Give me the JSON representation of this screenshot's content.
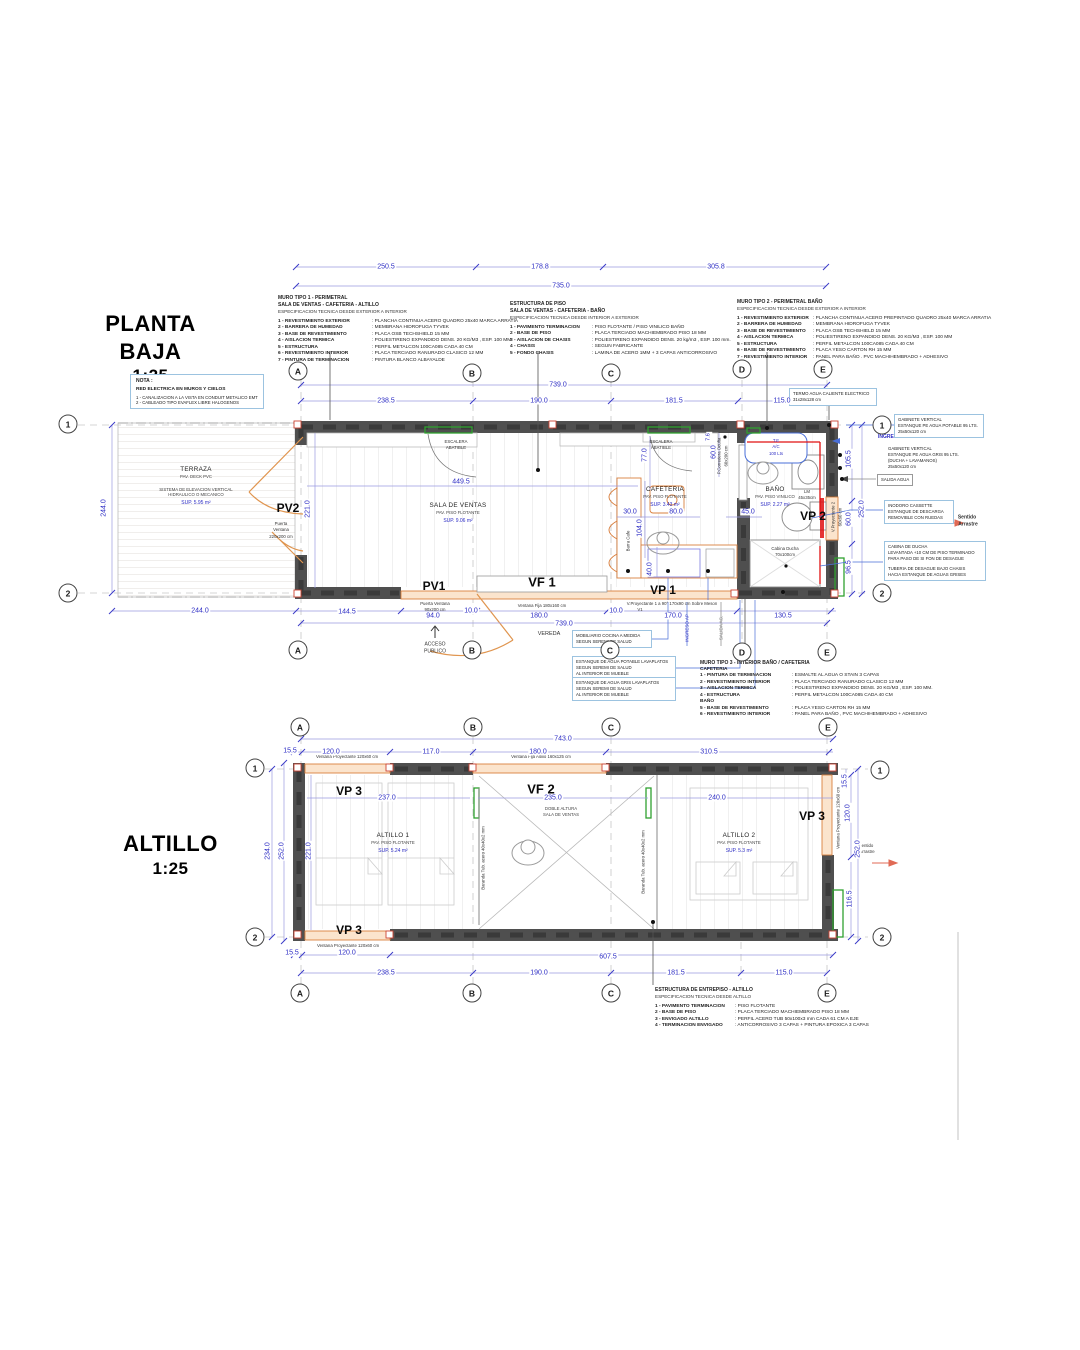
{
  "titles": {
    "pb": "PLANTA BAJA",
    "pb_scale": "1:25",
    "alt": "ALTILLO",
    "alt_scale": "1:25"
  },
  "grid": {
    "a": "A",
    "b": "B",
    "c": "C",
    "d": "D",
    "e": "E",
    "r1": "1",
    "r2": "2"
  },
  "nota": {
    "t": "NOTA :",
    "s": "RED ELECTRICA EN MUROS Y CIELOS",
    "l1": "1 - CANALIZACION A LA VISTA EN CONDUIT METALICO EMT",
    "l2": "2 - CABLEADO TIPO EVAFLEX LIBRE HALOGENOS"
  },
  "specs": {
    "muro1": {
      "t1": "MURO TIPO 1 - PERIMETRAL",
      "t2": "SALA DE VENTAS - CAFETERIA - ALTILLO",
      "t3": "ESPECIFICACION TECNICA DESDE EXTERIOR A INTERIOR",
      "items": [
        {
          "k": "1 - REVESTIMIENTO EXTERIOR",
          "v": ": PLANCHA CONTINUA ACERO QUADRO 25x40 MARCA ARRATIA"
        },
        {
          "k": "2 - BARRERA DE HUMEDAD",
          "v": ": MEMBRANA HIDROFUGA TYVEK"
        },
        {
          "k": "3 - BASE DE REVESTIMIENTO",
          "v": ": PLACA OSB TECHSHIELD 15 MM"
        },
        {
          "k": "4 - AISLACION TERMICA",
          "v": ": POLIESTIRENO EXPANDIDO DENS. 20 KG/M3 , ESP. 100 MM"
        },
        {
          "k": "5 - ESTRUCTURA",
          "v": ": PERFIL METALCON 100CA085 CADA 40 CM"
        },
        {
          "k": "6 - REVESTIMIENTO INTERIOR",
          "v": ": PLACA TERCIADO RANURADO CLASICO 12 MM"
        },
        {
          "k": "7 - PINTURA DE TERMINACION",
          "v": ": PINTURA BLANCO ALBAYALDE"
        }
      ]
    },
    "piso": {
      "t1": "ESTRUCTURA DE PISO",
      "t2": "SALA DE VENTAS - CAFETERIA - BAÑO",
      "t3": "ESPECIFICACION TECNICA DESDE INTERIOR A EXTERIOR",
      "items": [
        {
          "k": "1 - PAVIMENTO TERMINACION",
          "v": ": PISO FLOTANTE / PISO VINILICO BAÑO"
        },
        {
          "k": "2 - BASE DE PISO",
          "v": ": PLACA TERCIADO MACHIEMBRADO PISO 18 MM"
        },
        {
          "k": "3 - AISLACION DE CHASIS",
          "v": ": POLIESTIRENO EXPANDIDO DENS. 20 kg/m3 , ESP. 100 mm."
        },
        {
          "k": "4 - CHASIS",
          "v": ": SEGUN FABRICANTE"
        },
        {
          "k": "5 - FONDO CHASIS",
          "v": ": LAMINA DE ACERO 1MM + 3 CAPAS ANTICORROSIVO"
        }
      ]
    },
    "muro2": {
      "t1": "MURO TIPO 2 - PERIMETRAL BAÑO",
      "t3": "ESPECIFICACION TECNICA DESDE EXTERIOR A INTERIOR",
      "items": [
        {
          "k": "1 - REVESTIMIENTO EXTERIOR",
          "v": ": PLANCHA CONTINUA ACERO PREPINTADO QUADRO 25x40 MARCA ARRATIA"
        },
        {
          "k": "2 - BARRERA DE HUMEDAD",
          "v": ": MEMBRANA HIDROFUGA TYVEK"
        },
        {
          "k": "3 - BASE DE REVESTIMIENTO",
          "v": ": PLACA OSB TECHSHIELD 15 MM"
        },
        {
          "k": "4 - AISLACION TERMICA",
          "v": ": POLIESTIRENO EXPANDIDO DENS. 20 KG/M3 , ESP. 100 MM"
        },
        {
          "k": "5 - ESTRUCTURA",
          "v": ": PERFIL METALCON 100CA085 CADA 40 CM"
        },
        {
          "k": "6 - BASE DE REVESTIMIENTO",
          "v": ": PLACA YESO CARTON RH 15 MM"
        },
        {
          "k": "7 - REVESTIMIENTO INTERIOR",
          "v": ": PANEL PARA BAÑO . PVC MACHIHEMBRADO + ADHESIVO"
        }
      ]
    },
    "muro3": {
      "t1": "MURO TIPO 3 - INTERIOR BAÑO / CAFETERIA",
      "s1": "CAFETERIA",
      "items1": [
        {
          "k": "1 - PINTURA DE TERMINACION",
          "v": ": ESMALTE AL AGUA O STAIN 3 CAPAS"
        },
        {
          "k": "2 - REVESTIMIENTO INTERIOR",
          "v": ": PLACA TERCIADO RANURADO CLASICO 12 MM"
        },
        {
          "k": "3 - AISLACION TERMICA",
          "v": ": POLIESTIRENO EXPANDIDO DENS. 20 KG/M3 , ESP. 100 MM."
        },
        {
          "k": "4 - ESTRUCTURA",
          "v": ": PERFIL METALCON 100CA085 CADA 40 CM"
        }
      ],
      "s2": "BAÑO",
      "items2": [
        {
          "k": "5 - BASE DE REVESTIMIENTO",
          "v": ": PLACA YESO CARTON RH 15 MM"
        },
        {
          "k": "6 - REVESTIMIENTO INTERIOR",
          "v": ": PANEL PARA BAÑO , PVC MACHIHEMBRADO + ADHESIVO"
        }
      ]
    },
    "entrepiso": {
      "t1": "ESTRUCTURA DE ENTREPISO - ALTILLO",
      "t3": "ESPECIFICACION TECNICA DESDE ALTILLO",
      "items": [
        {
          "k": "1 - PAVIMENTO TERMINACION",
          "v": ": PISO FLOTANTE"
        },
        {
          "k": "2 - BASE DE PISO",
          "v": ": PLACA TERCIADO MACHIEMBRADO PISO 18 MM"
        },
        {
          "k": "3 - ENVIGADO ALTILLO",
          "v": ": PERFIL ACERO TUB 50x100x3 mm CADA 61 CM A EJE"
        },
        {
          "k": "4 - TERMINACION ENVIGADO",
          "v": ": ANTICORROSIVO 3 CAPAS + PINTURA EPOXICA 3 CAPAS"
        }
      ]
    }
  },
  "rooms": {
    "terraza": {
      "name": "TERRAZA",
      "pav": "PAV. DECK PVC",
      "e1": "SISTEMA DE ELEVACION VERTICAL",
      "e2": "HIDRAULICO O MECANICO",
      "sup": "SUP. 5.95 m²"
    },
    "sala": {
      "name": "SALA DE VENTAS",
      "pav": "PAV. PISO FLOTANTE",
      "sup": "SUP. 9.06 m²"
    },
    "cafeteria": {
      "name": "CAFETERIA",
      "pav": "PAV. PISO FLOTANTE",
      "sup": "SUP. 3.43 m²"
    },
    "bano": {
      "name": "BAÑO",
      "pav": "PAV. PISO VINILICO",
      "sup": "SUP. 2.27 m²"
    },
    "altillo1": {
      "name": "ALTILLO 1",
      "pav": "PAV. PISO FLOTANTE",
      "sup": "SUP. 5.24 m²"
    },
    "altillo2": {
      "name": "ALTILLO 2",
      "pav": "PAV. PISO FLOTANTE",
      "sup": "SUP. 5.3 m²"
    },
    "doble": {
      "l1": "DOBLE ALTURA",
      "l2": "SALA DE VENTAS"
    }
  },
  "windows": {
    "pv2": {
      "tag": "PV2",
      "l1": "Puerta",
      "l2": "Ventana",
      "l3": "220x200 cm"
    },
    "pv1": {
      "tag": "PV1",
      "l1": "Puerta Ventana",
      "l2": "90x200 cm"
    },
    "vf1": {
      "tag": "VF 1",
      "l1": "Ventana Fija 180x160 cm"
    },
    "vp1": {
      "tag": "VP 1",
      "l1": "V.Proyectante 1 a 90° 170x90 cm Sobre Meson",
      "l2": "V1"
    },
    "vp2": {
      "tag": "VP 2",
      "l1": "V.Proyectante 2",
      "l2": "60x60 cm"
    },
    "vf2": {
      "tag": "VF 2",
      "l1": "Ventana Fija Altillo 160x125 cm"
    },
    "vp3": {
      "tag": "VP 3",
      "l1": "Ventana Proyectante 120x60 cm"
    }
  },
  "labels": {
    "escalera1": "ESCALERA",
    "escalera2": "ABATIBLE",
    "barra": "Barra Cafe",
    "corredera1": "P.Corredera Oculta",
    "corredera2": "60x200 cm",
    "lm1": "LM",
    "lm2": "45x35cm",
    "ducha1": "Cabina Ducha",
    "ducha2": "70x100cm",
    "te1": "T.E",
    "te2": "A/C",
    "te3": "100 Lts",
    "baranda": "Baranda Tub. acero 40x40x2 mm",
    "acceso1": "ACCESO",
    "acceso2": "PUBLICO",
    "vereda": "VEREDA",
    "ingreso_ap": "INGRESO AP",
    "salida_ag": "SALIDA AG.",
    "sentido1": "Sentido",
    "sentido2": "Arrastre"
  },
  "notes": {
    "termo": {
      "l1": "TERMO AGUA CALIENTE ELECTRICO",
      "l2": "31x28x128 cm"
    },
    "gab1": {
      "l1": "GABINETE VERTICAL",
      "l2": "ESTANQUE PE AGUA POTABLE 95 LTS.",
      "l3": "25x50x120 cm"
    },
    "gab2": {
      "l1": "GABINETE VERTICAL",
      "l2": "ESTANQUE PE AGUA GRIS 95 LTS.",
      "l3": "(DUCHA + LAVAMANOS)",
      "l4": "25x50x120 cm"
    },
    "salida_agua": "SALIDA AGUA",
    "inodoro": {
      "l1": "INODORO CASSETTE",
      "l2": "ESTANQUE DE DESCARGA",
      "l3": "REMOVIBLE CON RUEDAS"
    },
    "cabina": {
      "l1": "CABINA DE DUCHA",
      "l2": "LEVANTADA +10 CM DE PISO TERMINADO",
      "l3": "PARA PASO DE SI FON DE DESAGUE",
      "l4": "TUBERIA DE DESAGUE BAJO CHASIS",
      "l5": "HACIA ESTANQUE DE AGUAS GRISES"
    },
    "mobiliario": {
      "l1": "MOBILIARIO COCINA A MEDIDA",
      "l2": "SEGUN SEREMI DE SALUD"
    },
    "est_potable": {
      "l1": "ESTANQUE DE AGUA POTABLE LAVAPLATOS",
      "l2": "SEGUN SEREMI DE SALUD",
      "l3": "AL INTERIOR DE MUEBLE"
    },
    "est_gris": {
      "l1": "ESTANQUE DE AGUA GRIS LAVAPLATOS",
      "l2": "SEGUN SEREMI DE SALUD",
      "l3": "AL INTERIOR DE MUEBLE"
    }
  },
  "dims": {
    "pb_top": [
      "250.5",
      "178.8",
      "305.8",
      "735.0"
    ],
    "pb_upper": [
      "739.0",
      "238.5",
      "190.0",
      "181.5",
      "115.0"
    ],
    "pb_left": [
      "244.0",
      "221.0"
    ],
    "pb_right": [
      "105.5",
      "60.0",
      "96.5",
      "252.0"
    ],
    "pb_inner": [
      "449.5",
      "77.0",
      "60.0",
      "7.6",
      "30.0",
      "80.0",
      "104.0",
      "45.0",
      "40.0"
    ],
    "pb_bottom": [
      "244.0",
      "144.5",
      "94.0",
      "10.0",
      "180.0",
      "10.0",
      "170.0",
      "130.5",
      "739.0"
    ],
    "alt_top": [
      "743.0",
      "15.5",
      "120.0",
      "117.0",
      "180.0",
      "310.5",
      "15.5"
    ],
    "alt_inner": [
      "237.0",
      "235.0",
      "240.0"
    ],
    "alt_left": [
      "234.0",
      "252.0",
      "221.0"
    ],
    "alt_right": [
      "120.0",
      "252.0",
      "116.5"
    ],
    "alt_bottom": [
      "15.5",
      "120.0",
      "607.5",
      "238.5",
      "190.0",
      "181.5",
      "115.0"
    ]
  },
  "colors": {
    "dim_blue": "#2c2cc4",
    "wall_gray": "#4f4f4f",
    "accent_orange": "#d9803f",
    "accent_green": "#2fa12f",
    "accent_red": "#e01010",
    "note_border": "#9cc3e0"
  }
}
